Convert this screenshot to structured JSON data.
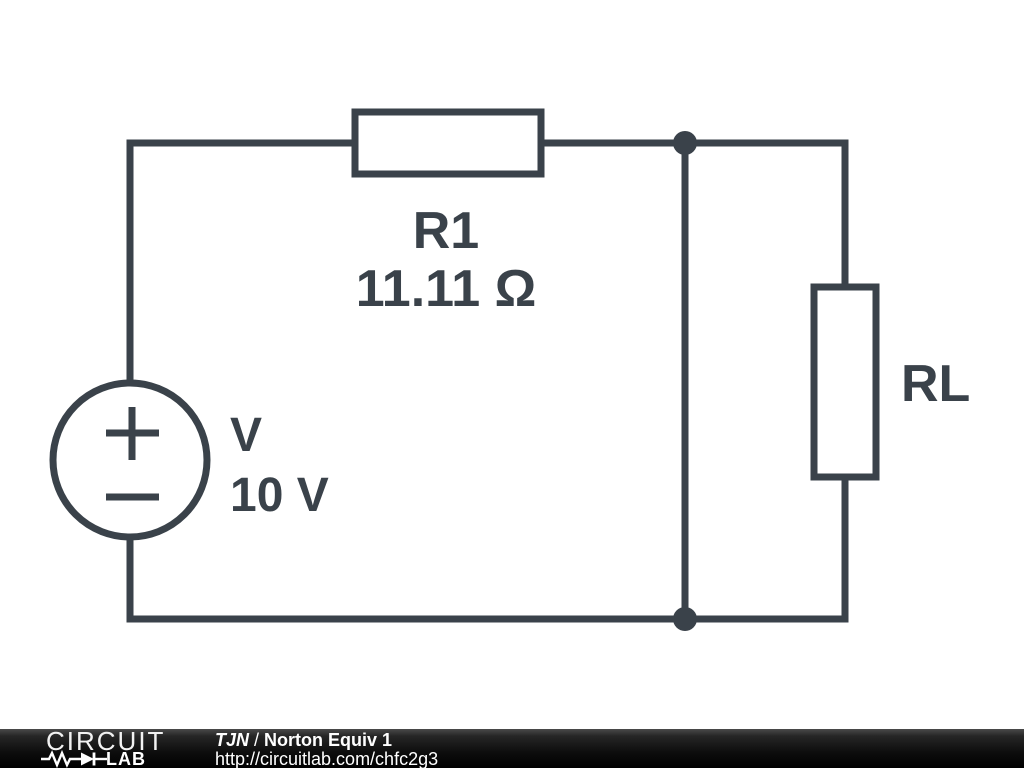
{
  "colors": {
    "circuit": "#3a424a",
    "background": "#ffffff",
    "footer_text": "#ffffff"
  },
  "circuit": {
    "source": {
      "name": "V",
      "value": "10 V"
    },
    "resistor_r1": {
      "name": "R1",
      "value": "11.11 Ω"
    },
    "resistor_rl": {
      "name": "RL"
    }
  },
  "footer": {
    "logo_line1": "CIRCUIT",
    "logo_line2": "LAB",
    "author": "TJN",
    "separator": "/",
    "title": "Norton Equiv 1",
    "url": "http://circuitlab.com/chfc2g3"
  }
}
